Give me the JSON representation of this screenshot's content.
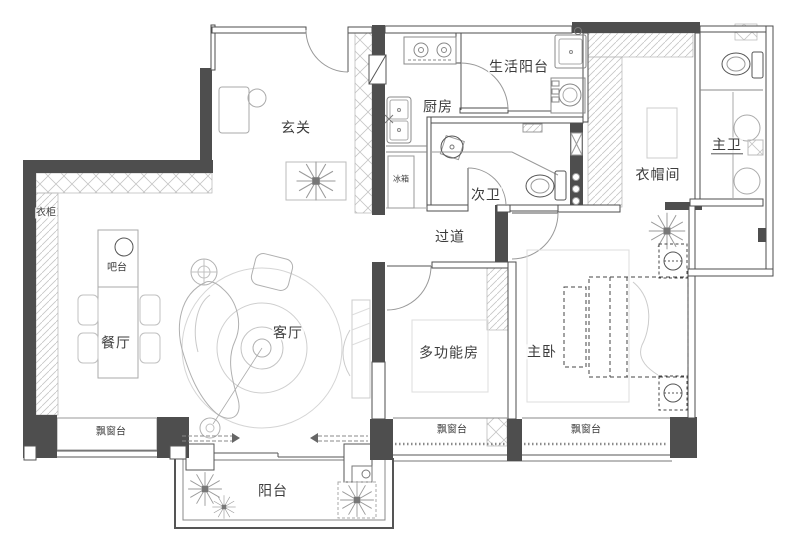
{
  "floorplan": {
    "rooms": {
      "entry": {
        "label": "玄关"
      },
      "kitchen": {
        "label": "厨房"
      },
      "living_balcony": {
        "label": "生活阳台"
      },
      "second_bath": {
        "label": "次卫"
      },
      "master_bath": {
        "label": "主卫"
      },
      "cloakroom": {
        "label": "衣帽间"
      },
      "corridor": {
        "label": "过道"
      },
      "dining": {
        "label": "餐厅"
      },
      "living": {
        "label": "客厅"
      },
      "multi_room": {
        "label": "多功能房"
      },
      "master_bedroom": {
        "label": "主卧"
      },
      "balcony": {
        "label": "阳台"
      }
    },
    "features": {
      "wardrobe": {
        "label": "衣柜"
      },
      "bar": {
        "label": "吧台"
      },
      "fridge": {
        "label": "冰箱"
      },
      "bay_window_dining": {
        "label": "飘窗台"
      },
      "bay_window_multi": {
        "label": "飘窗台"
      },
      "bay_window_master": {
        "label": "飘窗台"
      }
    },
    "colors": {
      "wall": "#4e4e4e",
      "line": "#555555",
      "light": "#c9c9c9"
    }
  }
}
